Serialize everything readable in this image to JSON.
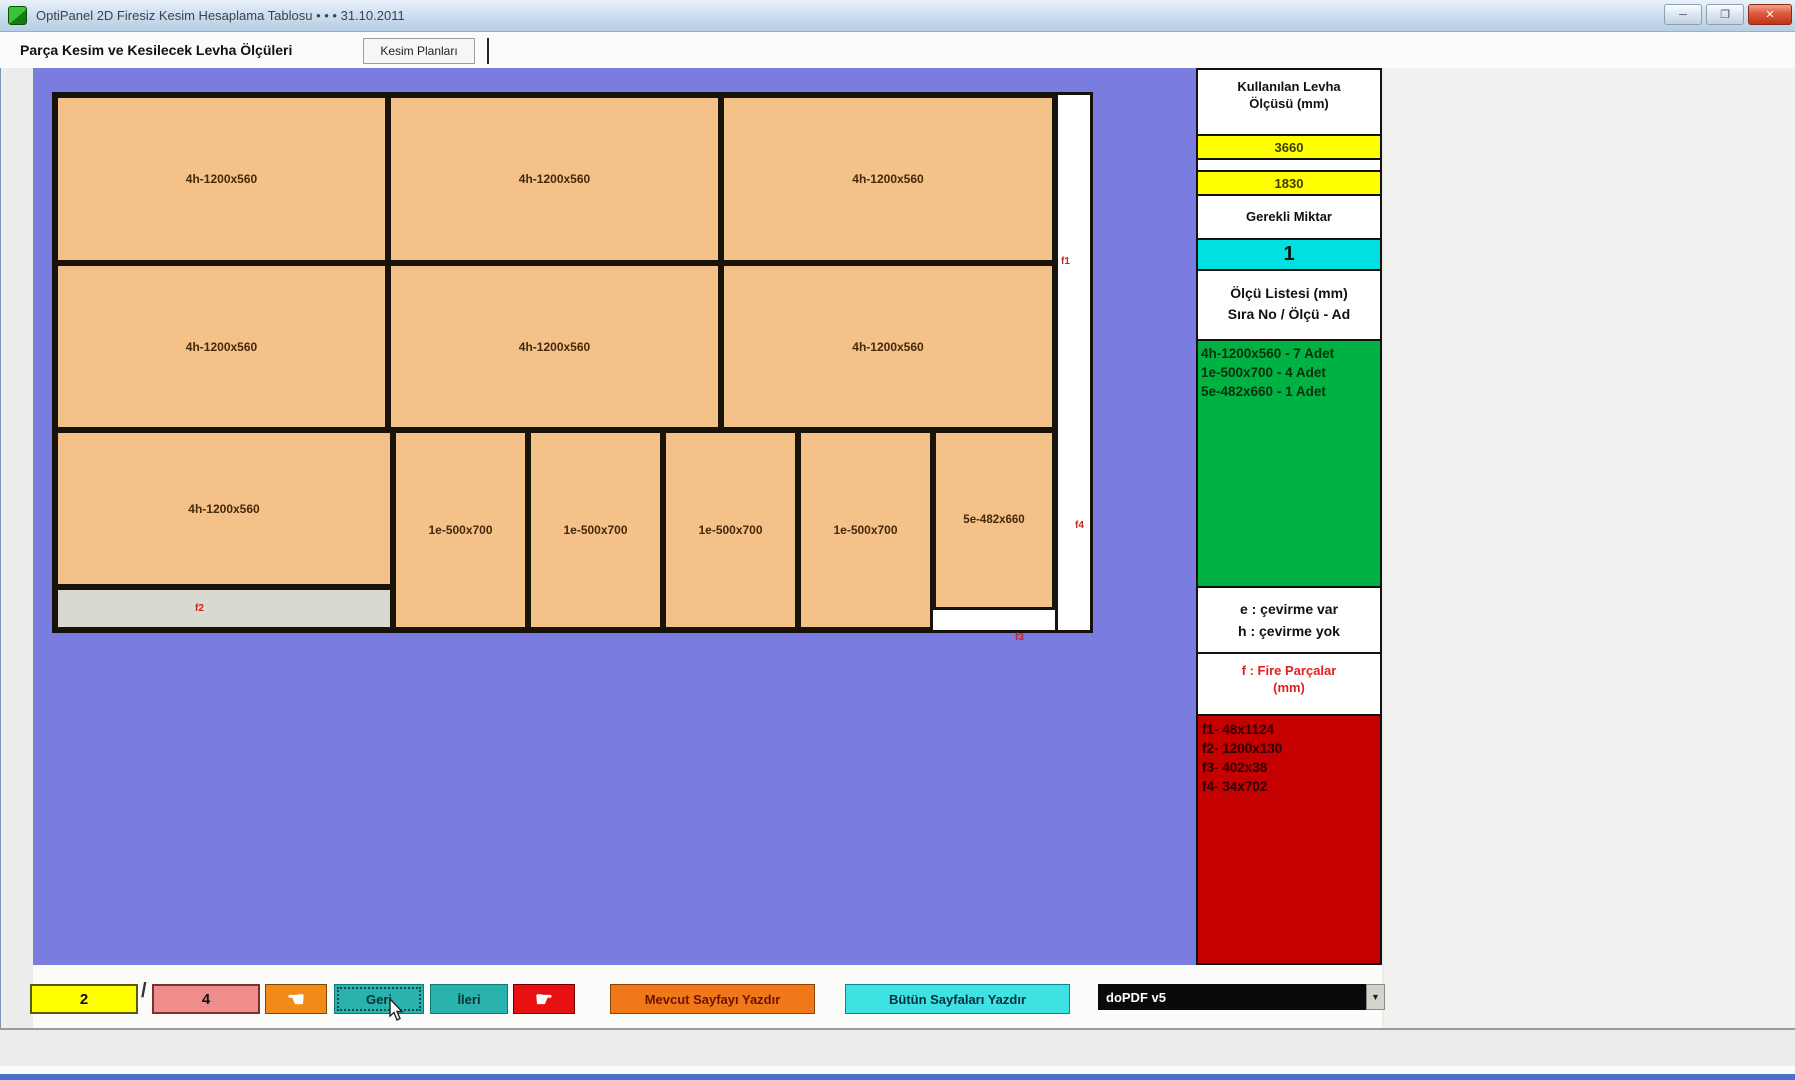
{
  "window": {
    "title": "OptiPanel 2D Firesiz Kesim Hesaplama Tablosu  •  •  •  31.10.2011",
    "minimize_glyph": "─",
    "maximize_glyph": "❐",
    "close_glyph": "✕"
  },
  "tabs": {
    "tab1": "Parça Kesim ve Kesilecek Levha Ölçüleri",
    "tab2": "Kesim Planları"
  },
  "plan": {
    "row1": [
      "4h-1200x560",
      "4h-1200x560",
      "4h-1200x560"
    ],
    "row2": [
      "4h-1200x560",
      "4h-1200x560",
      "4h-1200x560"
    ],
    "row3_large": "4h-1200x560",
    "row3_columns": [
      "1e-500x700",
      "1e-500x700",
      "1e-500x700",
      "1e-500x700"
    ],
    "row3_last": "5e-482x660",
    "fire_markers": [
      "f1",
      "f2",
      "f3",
      "f4"
    ]
  },
  "sidebar": {
    "used_sheet_header_line1": "Kullanılan Levha",
    "used_sheet_header_line2": "Ölçüsü (mm)",
    "sheet_width": "3660",
    "sheet_height": "1830",
    "required_label": "Gerekli Miktar",
    "required_qty": "1",
    "list_header_line1": "Ölçü Listesi (mm)",
    "list_header_line2": "Sıra No / Ölçü - Ad",
    "size_list": [
      "4h-1200x560 - 7 Adet",
      "1e-500x700 - 4 Adet",
      "5e-482x660 - 1 Adet"
    ],
    "legend_line1": "e : çevirme var",
    "legend_line2": "h : çevirme yok",
    "fire_header_line1": "f : Fire Parçalar",
    "fire_header_line2": "(mm)",
    "fire_list": [
      "f1- 48x1124",
      "f2- 1200x130",
      "f3- 402x38",
      "f4- 34x702"
    ]
  },
  "toolbar": {
    "current_page": "2",
    "page_separator": "/",
    "total_pages": "4",
    "back_label": "Geri",
    "forward_label": "İleri",
    "print_current_label": "Mevcut Sayfayı Yazdır",
    "print_all_label": "Bütün Sayfaları Yazdır",
    "printer_value": "doPDF v5"
  },
  "icons": {
    "first_page_hand": "☚",
    "last_page_hand": "☛",
    "dropdown_arrow": "▼"
  },
  "colors": {
    "canvas_background": "#7b7ce0",
    "panel_fill": "#f4c189",
    "sheet_white": "#ffffff",
    "fire_gray": "#d9d9d1",
    "sidebar_yellow": "#ffff00",
    "qty_cyan": "#00e0e0",
    "list_green": "#00b244",
    "fire_red_panel": "#c40000",
    "teal_button": "#2ab3ad",
    "orange_button": "#f07818",
    "red_button": "#e81010",
    "salmon_box": "#ef8c8c",
    "printer_black": "#0a0a0a"
  }
}
